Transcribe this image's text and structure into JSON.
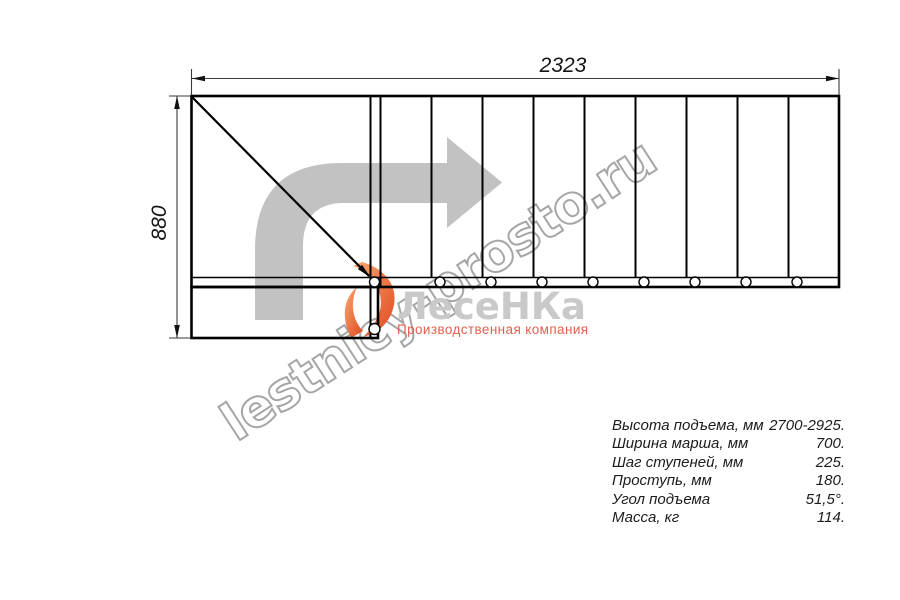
{
  "drawing": {
    "top_dimension": "2323",
    "left_dimension": "880"
  },
  "watermark": {
    "text": "lestnicy-prosto.ru"
  },
  "logo": {
    "name": "ЛесеНКа",
    "subtitle": "Производственная компания"
  },
  "specs": {
    "rows": [
      {
        "label": "Высота подъема, мм",
        "value": "2700-2925."
      },
      {
        "label": "Ширина марша, мм",
        "value": "700."
      },
      {
        "label": "Шаг ступеней, мм",
        "value": "225."
      },
      {
        "label": "Проступь, мм",
        "value": "180."
      },
      {
        "label": "Угол подъема",
        "value": "51,5°."
      },
      {
        "label": "Масса, кг",
        "value": "114."
      }
    ]
  },
  "colors": {
    "line": "#000000",
    "dimension": "#3a3a3a",
    "arrow_gray": "#c2c2c2",
    "watermark_gray": "#a6a6a6",
    "logo_gray": "#c9c9c9",
    "logo_accent": "#e2604e",
    "flame_light": "#f29a63",
    "flame_dark": "#e1481f"
  }
}
